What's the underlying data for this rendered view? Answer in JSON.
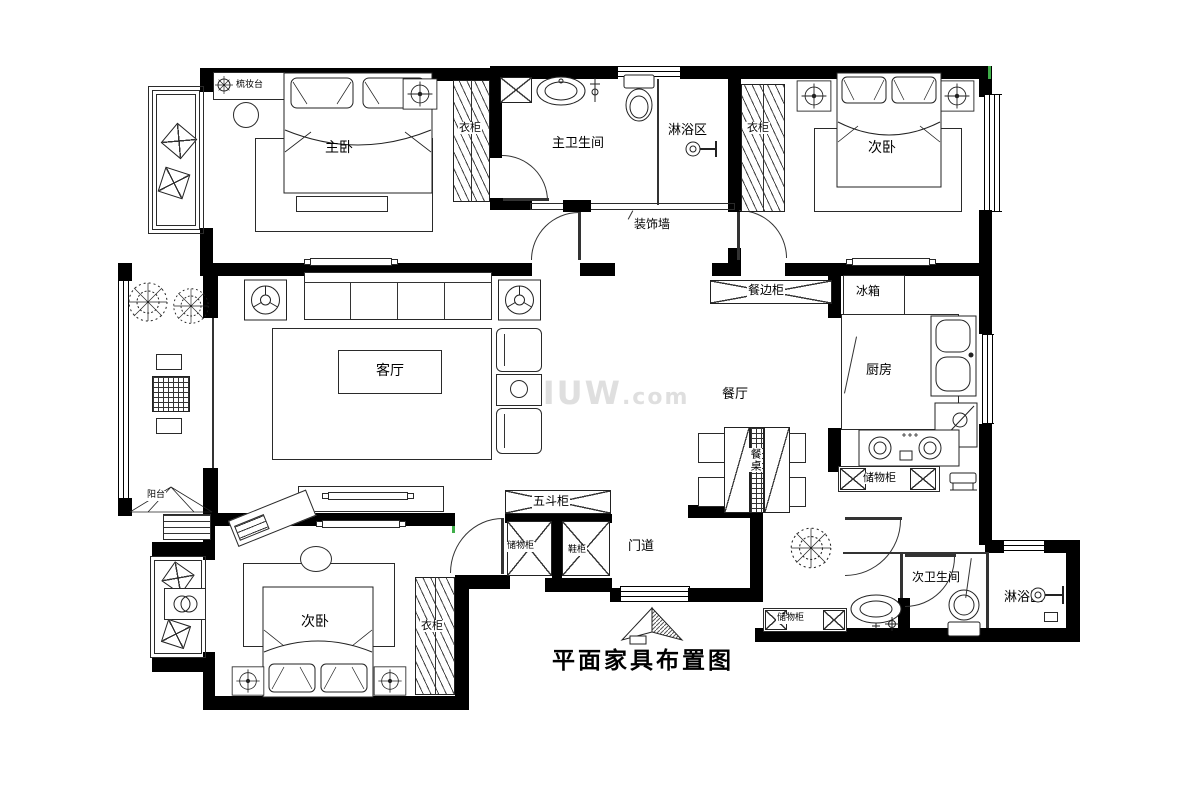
{
  "title": "平面家具布置图",
  "watermark": {
    "main": "AIUW",
    "dom": ".com"
  },
  "colors": {
    "wall": "#000000",
    "line": "#2a2a2a",
    "watermark": "#cbcbcb",
    "artifact_green": "#3fae49"
  },
  "rooms": {
    "master_bedroom": "主卧",
    "master_bathroom": "主卫生间",
    "shower_top": "淋浴区",
    "bedroom_top": "次卧",
    "living_room": "客厅",
    "dining_room": "餐厅",
    "kitchen": "厨房",
    "hallway": "门道",
    "balcony": "阳台",
    "bedroom_bottom": "次卧",
    "bathroom_second": "次卫生间",
    "shower_bottom": "淋浴区"
  },
  "furniture": {
    "dressing_table": "梳妆台",
    "wardrobe_master": "衣柜",
    "wardrobe_top": "衣柜",
    "wardrobe_bottom": "衣柜",
    "decorative_wall": "装饰墙",
    "sideboard": "餐边柜",
    "fridge": "冰箱",
    "dining_table": "餐桌",
    "storage_kitchen": "储物柜",
    "five_drawer_chest": "五斗柜",
    "storage_entry": "储物柜",
    "shoe_cabinet": "鞋柜",
    "storage_corridor": "储物柜"
  }
}
